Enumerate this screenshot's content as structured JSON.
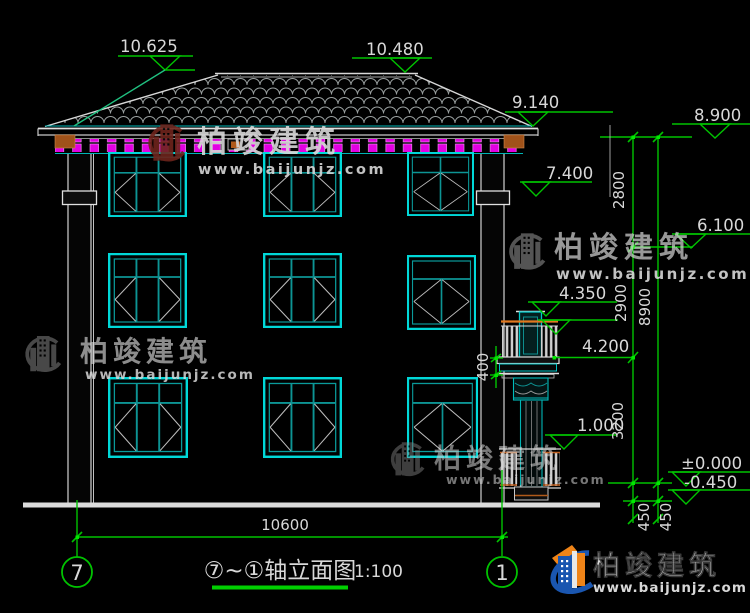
{
  "drawing_title": {
    "axes_range": "⑦~①轴立面图",
    "scale": "1:100"
  },
  "axis_bubbles": {
    "left": "7",
    "right": "1"
  },
  "elevations": {
    "ridge_left": "10.625",
    "ridge_right": "10.480",
    "eave_right": "9.140",
    "eave_level": "8.900",
    "floor3": "7.400",
    "level_6100": "6.100",
    "balcony_rail": "4.350",
    "balcony_slab": "4.200",
    "porch": "1.000",
    "zero": "±0.000",
    "site": "-0.450"
  },
  "dimensions": {
    "story3_height": "2800",
    "story2_height": "2900",
    "story1_height": "3200",
    "total_height": "8900",
    "balcony_slab_height": "400",
    "plinth_upper": "450",
    "plinth_lower": "450",
    "building_width": "10600"
  },
  "watermark": {
    "brand": "柏竣建筑",
    "website": "www.baijunjz.com"
  },
  "logo": {
    "brand": "柏竣建筑",
    "website": "www.baijunjz.com"
  },
  "colors": {
    "background": "#000000",
    "dimension_green": "#00c300",
    "window_cyan": "#00d8d8",
    "window_teal": "#0d9494",
    "dentil_magenta": "#e200e2",
    "line_white": "#d8d8d8",
    "logo_blue": "#1a56b0",
    "logo_orange": "#ef8418",
    "watermark_maroon": "#6e241c"
  }
}
